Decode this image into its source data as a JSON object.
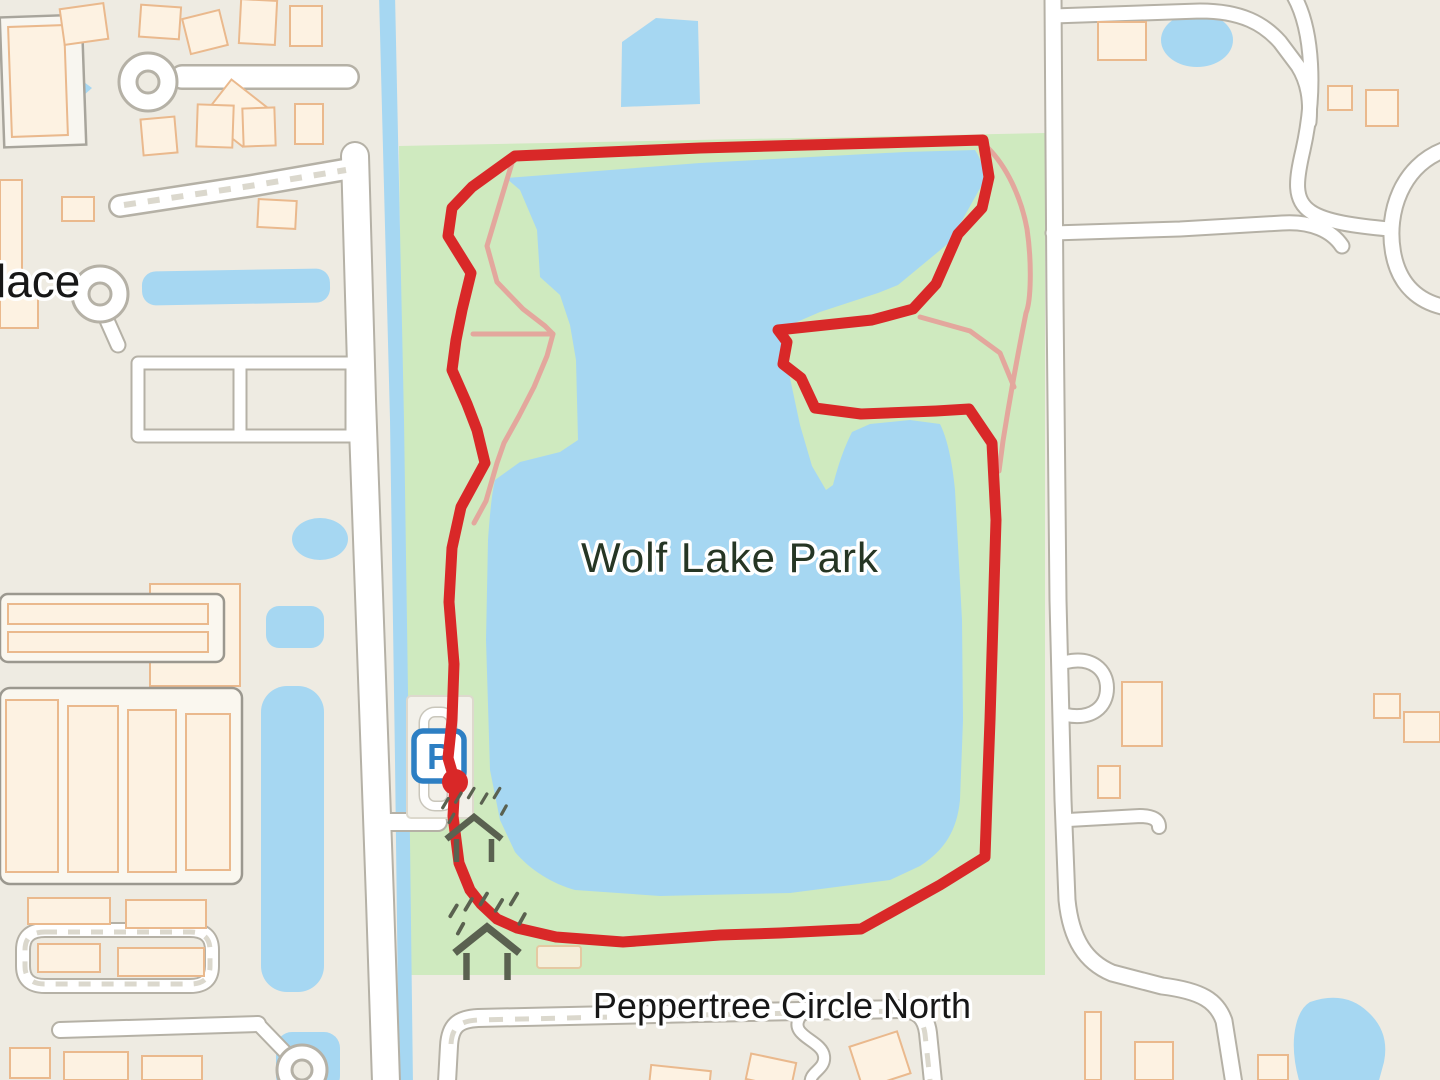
{
  "map": {
    "park_label": "Wolf Lake Park",
    "street_label": "Peppertree Circle North",
    "partial_street_label": "lace",
    "parking_icon_letter": "P"
  },
  "theme": {
    "land": "#eeebe2",
    "park": "#cfeabf",
    "water": "#a6d7f2",
    "route": "#d92828",
    "trail": "#e3a79d",
    "road_fill": "#ffffff",
    "road_casing": "#b5b1a6",
    "building_fill": "#fdf2e2",
    "building_stroke": "#eab98d",
    "label_park": "#263624",
    "label_street": "#171717",
    "parking_blue": "#2d7fc3",
    "shelter": "#5a6150"
  },
  "route": {
    "points": "455,782 448,758 452,720 454,664 449,602 452,548 461,507 485,463 477,430 467,404 452,370 456,340 462,310 471,273 448,236 452,208 472,187 515,156 700,148 880,143 983,140 989,177 982,208 958,234 936,284 913,309 872,320 778,330 787,342 783,364 801,378 815,408 861,414 936,411 969,409 992,443 996,520 993,620 990,720 987,800 985,857 940,885 861,929 780,933 720,935 623,942 556,937 517,928 497,919 481,904 470,890 459,863 453,816 455,782",
    "start": {
      "cx": "455",
      "cy": "782"
    },
    "trails": [
      "M 512,163 L 499,206 487,246 497,282 523,309 545,326 553,334 547,356 534,387 519,416 504,443 497,463 486,501 474,523",
      "M 473,334 L 553,334",
      "M 988,148 C 1006,166 1021,196 1027,229 C 1032,263 1031,301 1026,313 C 1018,353 1011,391 1003,441 L 999,471",
      "M 920,317 L 970,331 1000,353 1014,387"
    ]
  }
}
